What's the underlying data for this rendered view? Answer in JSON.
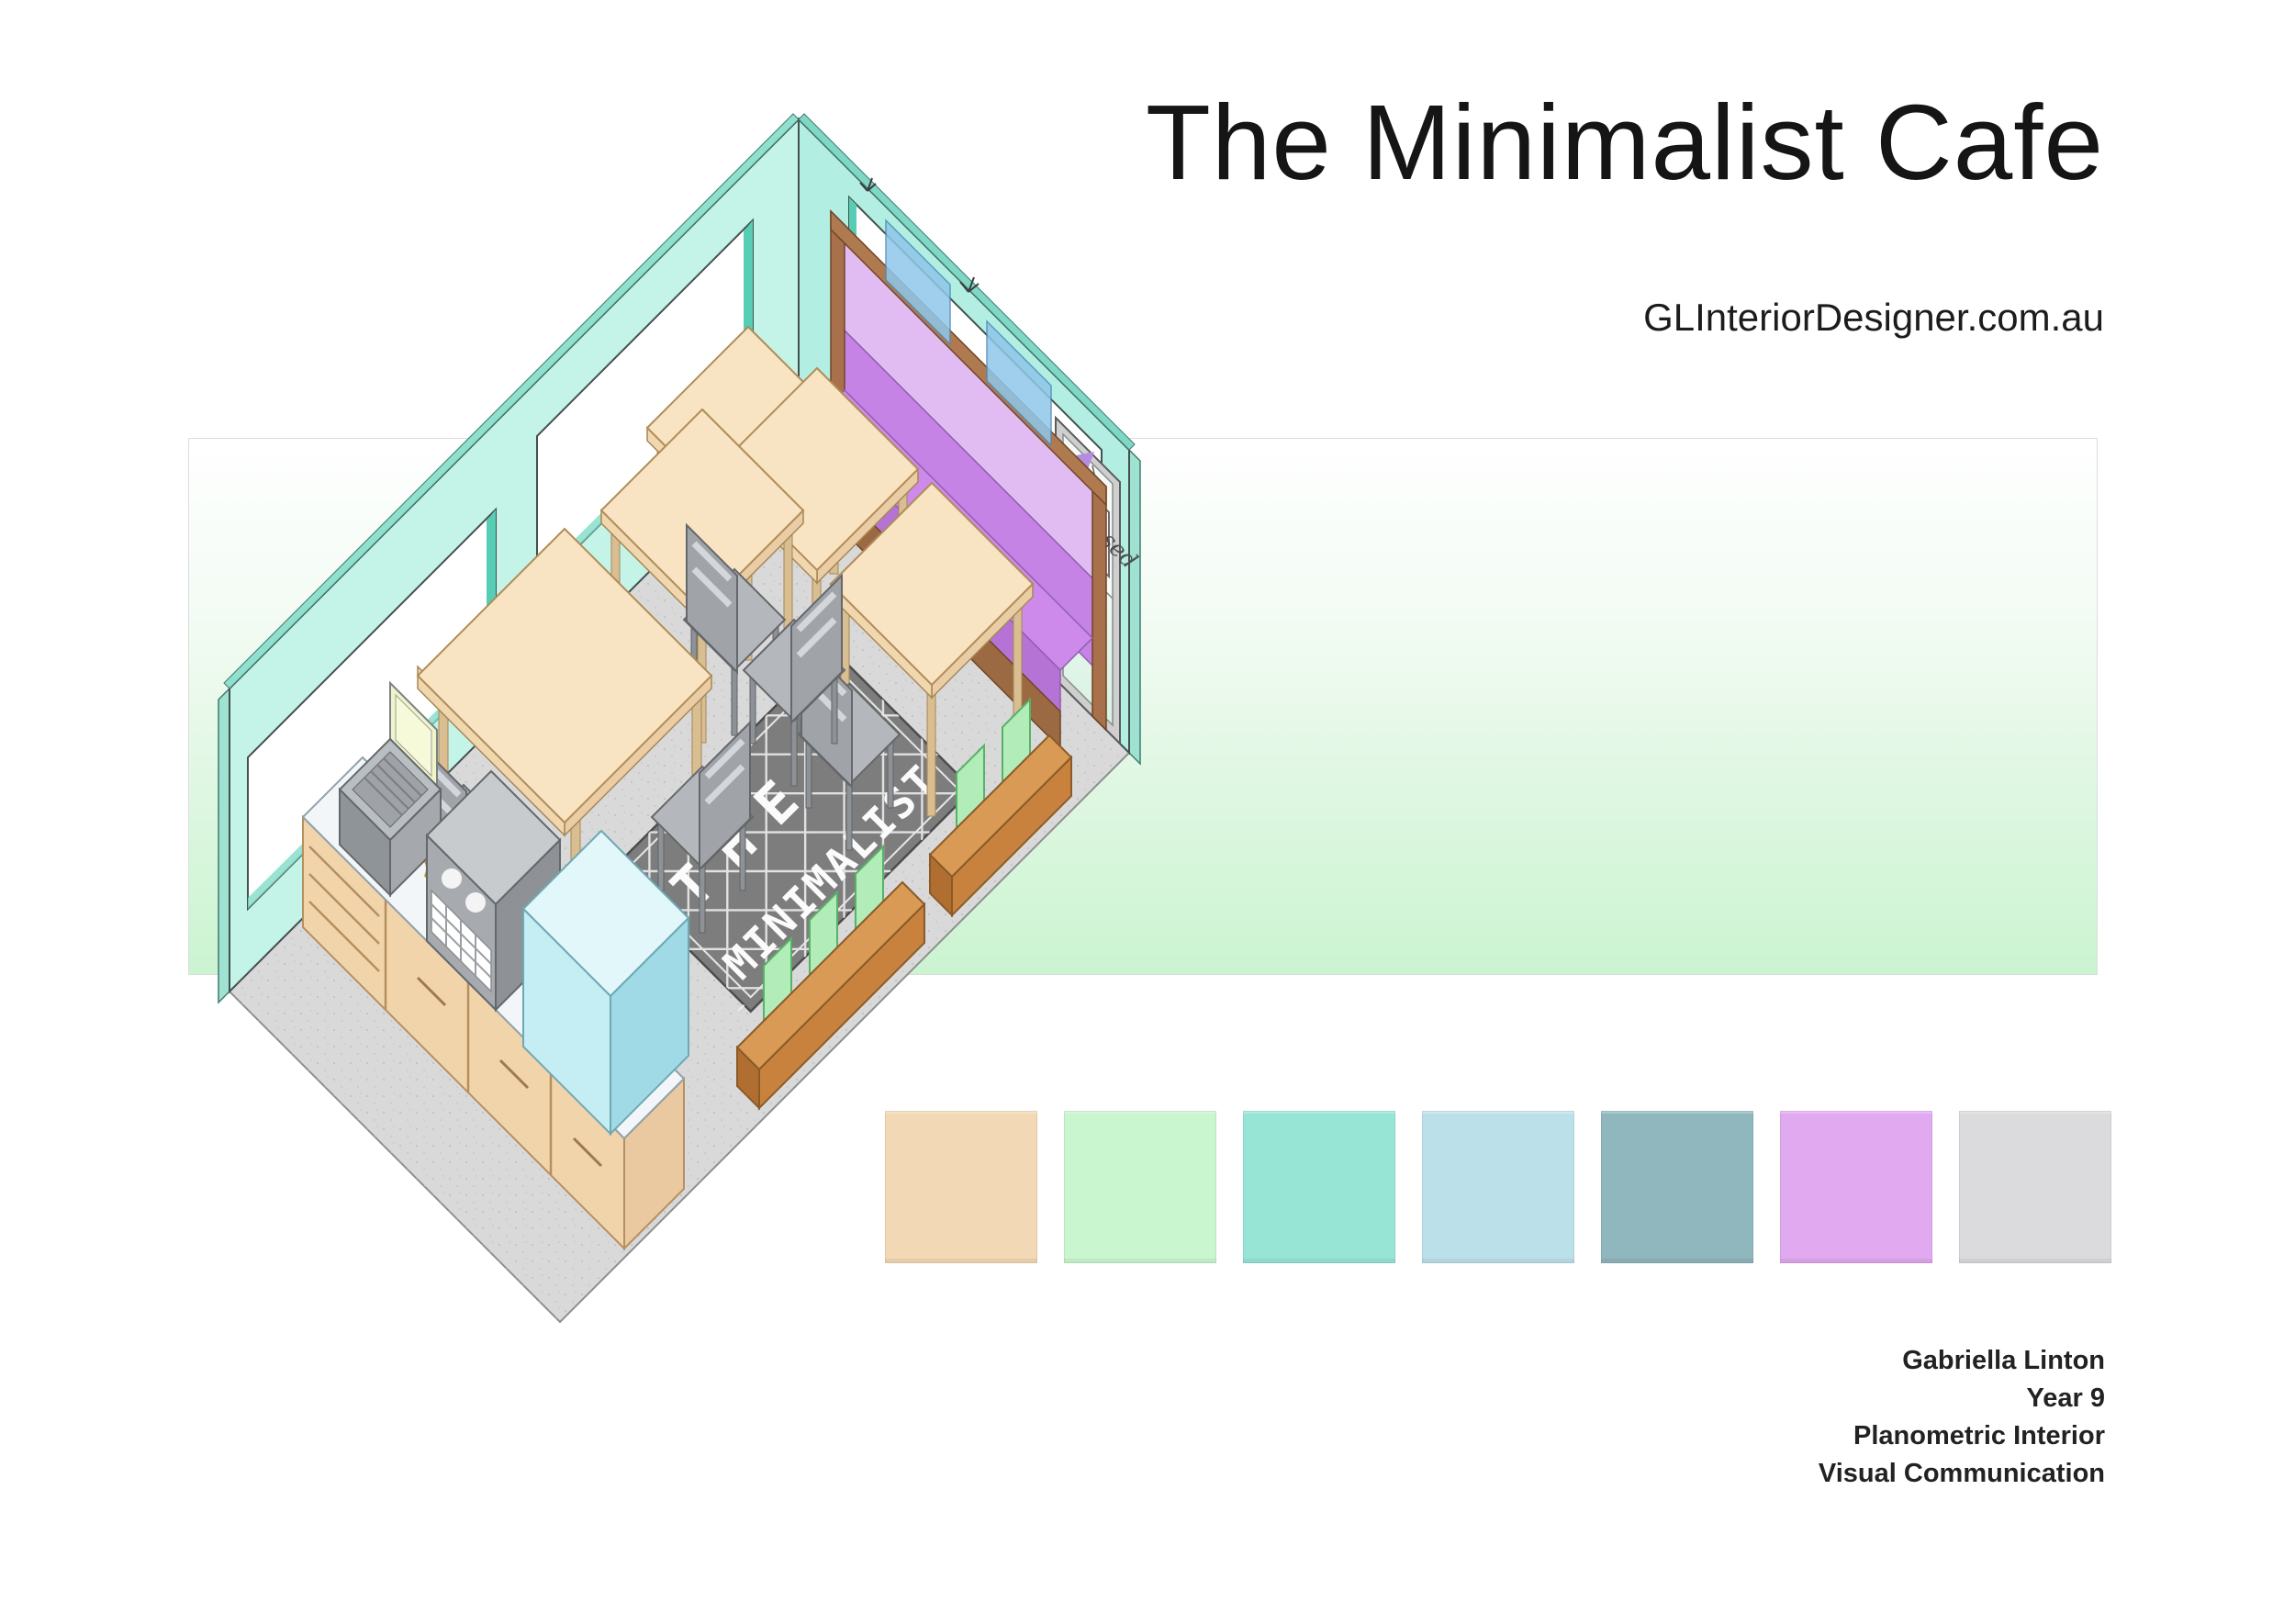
{
  "header": {
    "title": "The Minimalist Cafe",
    "website": "GLInteriorDesigner.com.au"
  },
  "drawing": {
    "rug_line1": "THE",
    "rug_line2": "MINIMALIST",
    "door_sign": "Closed"
  },
  "palette": {
    "swatches": [
      {
        "name": "sand",
        "hex": "#F2D8B4"
      },
      {
        "name": "mint-green",
        "hex": "#C9F6CE"
      },
      {
        "name": "aqua",
        "hex": "#97E5D5"
      },
      {
        "name": "powder-blue",
        "hex": "#BCE0EA"
      },
      {
        "name": "slate-teal",
        "hex": "#8FB7BD"
      },
      {
        "name": "lavender",
        "hex": "#E0A9F0"
      },
      {
        "name": "light-gray",
        "hex": "#DBDBDD"
      }
    ]
  },
  "credits": {
    "lines": [
      "Gabriella Linton",
      "Year 9",
      "Planometric Interior",
      "Visual Communication"
    ]
  },
  "colors": {
    "band_top": "#FFFFFF",
    "band_bottom": "#CBF4D1",
    "wall_mint": "#BFF1E5",
    "floor_gray": "#D9D9D9",
    "banquette_lavender": "#DCAEF0",
    "bench_wood": "#C9823E",
    "table_sand": "#F7DFBC"
  }
}
